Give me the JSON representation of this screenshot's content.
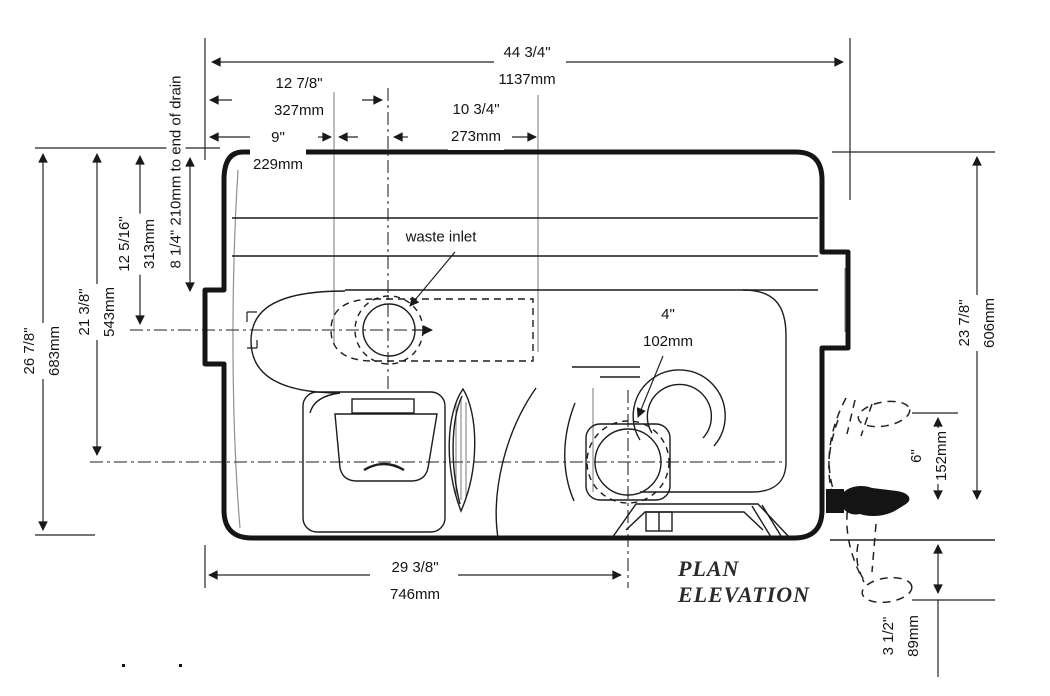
{
  "labels": {
    "waste_inlet": "waste inlet",
    "plan": "PLAN",
    "elevation": "ELEVATION"
  },
  "notes": {
    "drain_note": "8 1/4\" 210mm to end of drain"
  },
  "dims": {
    "overall_length": {
      "in": "44 3/4\"",
      "mm": "1137mm"
    },
    "inlet_from_end": {
      "in": "12 7/8\"",
      "mm": "327mm"
    },
    "inlet_to_drain": {
      "in": "10 3/4\"",
      "mm": "273mm"
    },
    "end_to_body": {
      "in": "9\"",
      "mm": "229mm"
    },
    "drain_diameter": {
      "in": "4\"",
      "mm": "102mm"
    },
    "overall_width": {
      "in": "26 7/8\"",
      "mm": "683mm"
    },
    "width_to_centerline": {
      "in": "21 3/8\"",
      "mm": "543mm"
    },
    "width_to_inlet": {
      "in": "12 5/16\"",
      "mm": "313mm"
    },
    "body_width": {
      "in": "23 7/8\"",
      "mm": "606mm"
    },
    "spout_clearance": {
      "in": "6\"",
      "mm": "152mm"
    },
    "spout_drop": {
      "in": "3 1/2\"",
      "mm": "89mm"
    },
    "drain_length": {
      "in": "29 3/8\"",
      "mm": "746mm"
    }
  }
}
